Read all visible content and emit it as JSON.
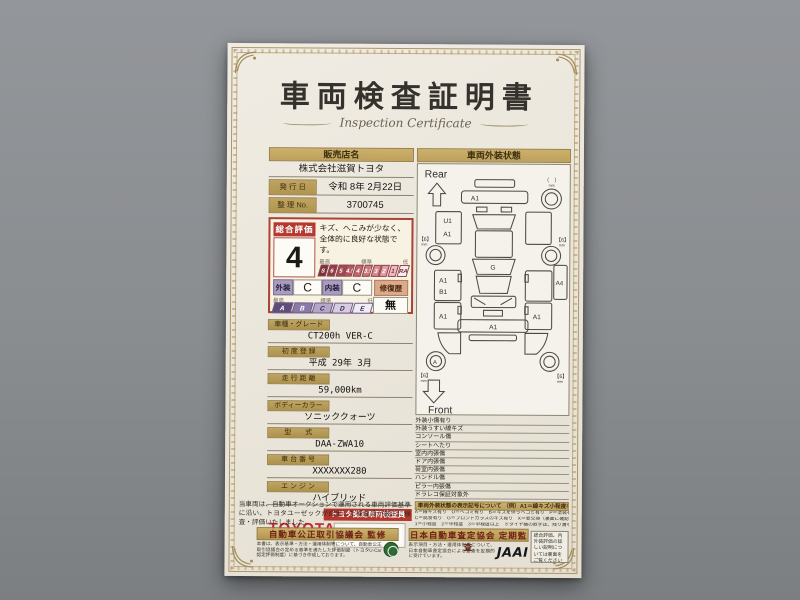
{
  "certificate": {
    "title_jp": "車両検査証明書",
    "title_en": "Inspection Certificate"
  },
  "dealer": {
    "label": "販売店名",
    "name": "株式会社滋賀トヨタ"
  },
  "issue_date": {
    "label": "発 行 日",
    "value": "令和 8年 2月22日"
  },
  "serial_no": {
    "label": "整 理 No.",
    "value": "3700745"
  },
  "overall": {
    "label": "総合評価",
    "grade": "4",
    "comment": "キズ、へこみが少なく、全体的に良好な状態です。",
    "scale_high": "最高",
    "scale_mid": "標準",
    "scale_low": "低",
    "scale": [
      "S",
      "6",
      "5",
      "4.5",
      "4",
      "3.5",
      "3",
      "2",
      "1",
      "RA/R"
    ]
  },
  "condition": {
    "exterior_label": "外装",
    "exterior_grade": "C",
    "interior_label": "内装",
    "interior_grade": "C",
    "repair_label": "修復歴",
    "repair_value": "無",
    "scale_high": "最高",
    "scale_mid": "標準",
    "scale_low": "低",
    "letter_scale": [
      "A",
      "B",
      "C",
      "D",
      "E"
    ]
  },
  "fields": [
    {
      "label": "車種・グレード",
      "value": "CT200h VER-C"
    },
    {
      "label": "初 度 登 録",
      "value": "平成 29年 3月"
    },
    {
      "label": "走 行 距 離",
      "value": "59,000km"
    },
    {
      "label": "ボディーカラー",
      "value": "ソニッククォーツ"
    },
    {
      "label": "型　　式",
      "value": "DAA-ZWA10"
    },
    {
      "label": "車 台 番 号",
      "value": "XXXXXXX280"
    },
    {
      "label": "エ ン ジ ン",
      "value": "ハイブリッド"
    }
  ],
  "inspector": {
    "brand": "TOYOTA",
    "badge": "トヨタ認定車両検査員"
  },
  "exterior_diagram": {
    "header": "車両外装状態",
    "rear_label": "Rear",
    "front_label": "Front",
    "panel_labels": {
      "rear_bumper": "A1",
      "left_quarter_top": "U1",
      "left_quarter": "A1",
      "left_door_a": "A1",
      "left_door_b": "B1",
      "left_door_rear": "A1",
      "right_quarter": "A4",
      "right_door": "A1",
      "windshield": "G",
      "front_bumper": "A1",
      "front_left_wheel": "A"
    },
    "tire_depth": "【6】",
    "tire_unit": "mm",
    "spare_depth": "（　）"
  },
  "memo_items": [
    "外装小傷有り",
    "外装うすい線キズ",
    "コンソール傷",
    "シートへたり",
    "室内内張傷",
    "ドア内張傷",
    "荷室内張傷",
    "ハンドル傷",
    "ピラー内張傷",
    "ドラレコ保証対象外"
  ],
  "left_note": "当車両は、自動車オークションで運用される車両評価基準に沿い、トヨタユーゼックが認定した検査員が厳正に検査・評価いたしました。",
  "symbols_note": {
    "title": "車両外装状態の表示記号について",
    "example": "（例）A1＝線キズ小程度有り",
    "line1": "A＝線キズ有り　U＝ヘコミ有り　B＝キズを伴うヘコミ有り　P＝塗装有　W＝補修跡有り　S＝サビ有り",
    "line2": "C＝腐食有り　G＝フロントガラスのキズ有り　X＝要交換（裏面に確認有り）　XX＝交換有り",
    "line3": "1＝小程度　2＝中程度　3＝中程度以上　※タイヤ横の数字は、残り溝を示しています。"
  },
  "footer": {
    "fair_trade": {
      "banner": "自動車公正取引協議会 監修",
      "note": "本書は、表示基準・方法・運用体制等について、自動車公正取引協議会の定める基準を満たした評価制度（トヨタU-Car認定評価制度）に基づき作成しております。"
    },
    "jaai": {
      "banner": "日本自動車査定協会 定期監査",
      "note": "表示項目・方法・運用体制等について、日本自動車査定協会による監査を定期的に受けています。",
      "logo": "JAAI"
    },
    "back_note": "総合評価、内外装評価の詳しい説明については裏面をご覧ください"
  }
}
